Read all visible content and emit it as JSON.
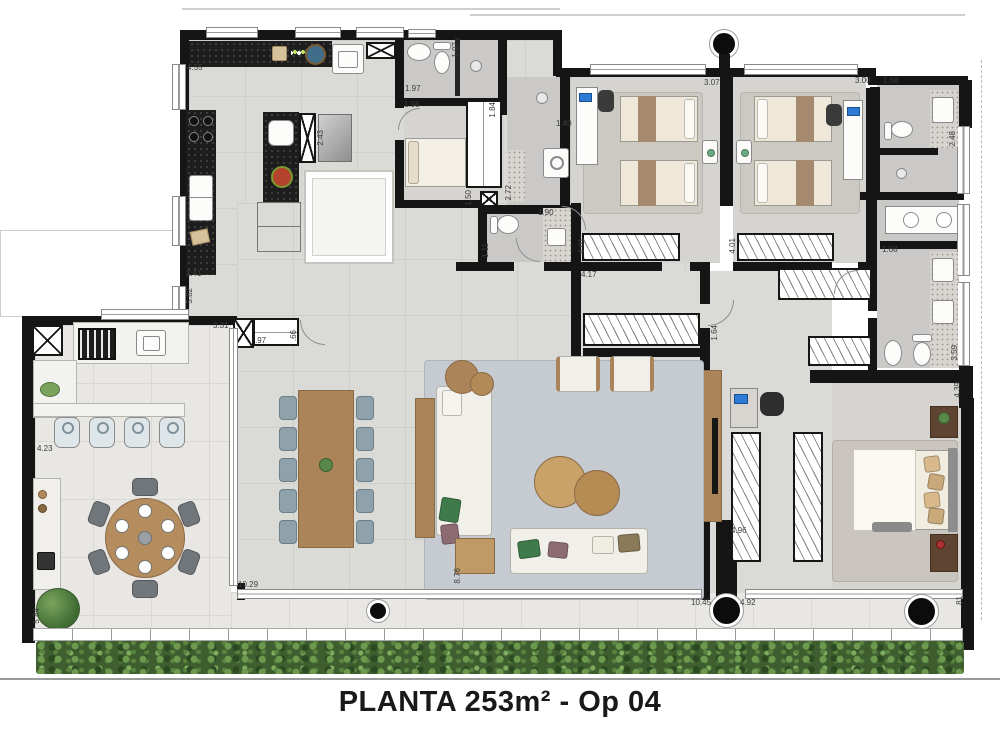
{
  "title": "PLANTA 253m² - Op 04",
  "plan": {
    "dimension_labels": [
      {
        "text": "4.55",
        "x": 187,
        "y": 64,
        "vert": false
      },
      {
        "text": "2.43",
        "x": 317,
        "y": 130,
        "vert": true
      },
      {
        "text": "2.41",
        "x": 186,
        "y": 270,
        "vert": false
      },
      {
        "text": "5.82",
        "x": 186,
        "y": 288,
        "vert": true
      },
      {
        "text": "1.97",
        "x": 405,
        "y": 85,
        "vert": false
      },
      {
        "text": "1.98",
        "x": 404,
        "y": 101,
        "vert": false
      },
      {
        "text": "1.07",
        "x": 452,
        "y": 42,
        "vert": true
      },
      {
        "text": "1.84",
        "x": 489,
        "y": 102,
        "vert": true
      },
      {
        "text": "1.50",
        "x": 465,
        "y": 190,
        "vert": true
      },
      {
        "text": "1.40",
        "x": 556,
        "y": 120,
        "vert": false
      },
      {
        "text": "2.72",
        "x": 505,
        "y": 185,
        "vert": true
      },
      {
        "text": "1.90",
        "x": 538,
        "y": 209,
        "vert": false
      },
      {
        "text": "1.11",
        "x": 482,
        "y": 243,
        "vert": true
      },
      {
        "text": "4.17",
        "x": 581,
        "y": 271,
        "vert": false
      },
      {
        "text": "4.01",
        "x": 578,
        "y": 238,
        "vert": true
      },
      {
        "text": "4.01",
        "x": 729,
        "y": 238,
        "vert": true
      },
      {
        "text": "3.07",
        "x": 704,
        "y": 79,
        "vert": false
      },
      {
        "text": "3.00",
        "x": 855,
        "y": 77,
        "vert": false
      },
      {
        "text": "1.68",
        "x": 883,
        "y": 77,
        "vert": false
      },
      {
        "text": "2.48",
        "x": 949,
        "y": 131,
        "vert": true
      },
      {
        "text": "1.68",
        "x": 882,
        "y": 246,
        "vert": false
      },
      {
        "text": "3.59",
        "x": 951,
        "y": 345,
        "vert": true
      },
      {
        "text": "4.39",
        "x": 954,
        "y": 382,
        "vert": true
      },
      {
        "text": "1.64",
        "x": 711,
        "y": 325,
        "vert": true
      },
      {
        "text": "3.31",
        "x": 213,
        "y": 322,
        "vert": false
      },
      {
        "text": ".97",
        "x": 255,
        "y": 337,
        "vert": false
      },
      {
        "text": ".66",
        "x": 290,
        "y": 330,
        "vert": true
      },
      {
        "text": "4.23",
        "x": 37,
        "y": 445,
        "vert": false
      },
      {
        "text": "4.96",
        "x": 731,
        "y": 527,
        "vert": false
      },
      {
        "text": "10.29",
        "x": 238,
        "y": 581,
        "vert": false
      },
      {
        "text": "8.76",
        "x": 454,
        "y": 568,
        "vert": true
      },
      {
        "text": "10.45",
        "x": 691,
        "y": 599,
        "vert": false
      },
      {
        "text": "4.92",
        "x": 740,
        "y": 599,
        "vert": false
      },
      {
        "text": ".81",
        "x": 956,
        "y": 596,
        "vert": true
      },
      {
        "text": "5.84",
        "x": 33,
        "y": 608,
        "vert": true
      }
    ],
    "colors": {
      "wall": "#151515",
      "floor_interior": "#dadad7",
      "floor_bedroom": "#d6d4d1",
      "floor_bath": "#cac9c7",
      "floor_terrace": "#e8e7e3",
      "granite": "#1d1d1d",
      "wood": "#ab8459",
      "wood_dark": "#5f4431",
      "rug_living": "#c6cbd1",
      "rug_bedroom": "#ccc8c2",
      "sofa": "#f0efe9",
      "chair_blue": "#8fa2ac",
      "hedge": "#4c6e38",
      "plant": "#58884a",
      "pillow_green": "#3f7a4a",
      "pillow_mauve": "#8d6b74",
      "screen_blue": "#2e7bd6"
    }
  }
}
